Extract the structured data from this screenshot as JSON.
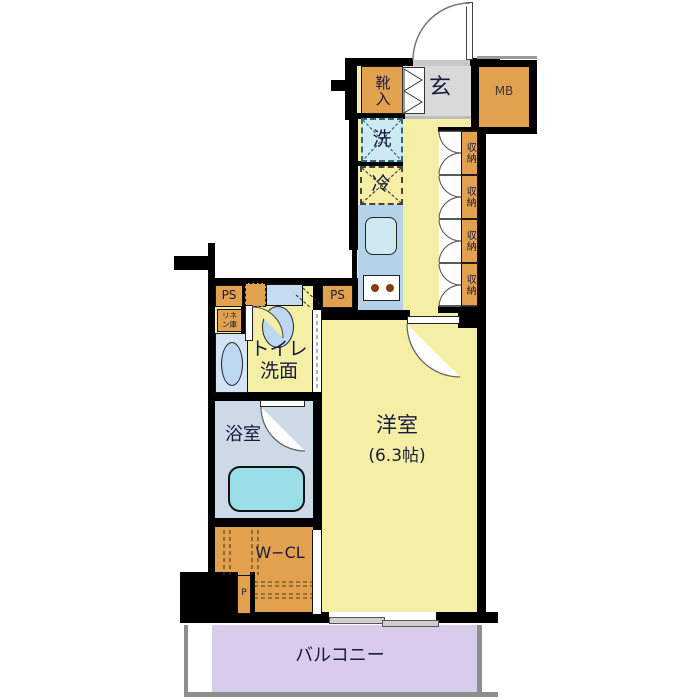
{
  "rooms": {
    "entrance": {
      "label": "玄"
    },
    "shoe_cabinet": {
      "label": "靴入"
    },
    "meter_box": {
      "label": "MB"
    },
    "washing_machine": {
      "label": "洗"
    },
    "refrigerator": {
      "label": "冷"
    },
    "storage_units": [
      {
        "label": "収納"
      },
      {
        "label": "収納"
      },
      {
        "label": "収納"
      },
      {
        "label": "収納"
      }
    ],
    "pipe_space_left": {
      "label": "PS"
    },
    "pipe_space_right": {
      "label": "PS"
    },
    "linen_closet": {
      "line1": "リネ",
      "line2": "ン庫"
    },
    "toilet_washroom": {
      "line1": "トイレ",
      "line2": "洗面"
    },
    "bathroom": {
      "label": "浴室"
    },
    "western_room": {
      "label": "洋室",
      "size": "(6.3帖)"
    },
    "walk_in_closet": {
      "label": "W−CL"
    },
    "pipe_shaft": {
      "label": "P"
    },
    "balcony": {
      "label": "バルコニー"
    }
  },
  "colors": {
    "floor_yellow": "#f4efa4",
    "cabinet_orange": "#e2a14e",
    "entry_gray": "#d9d9d9",
    "kitchen_blue": "#b6d2e8",
    "fixture_blue": "#bcd8f0",
    "washer_cyan": "#cdeaf2",
    "bath_gray_blue": "#ccd9e6",
    "bathtub_cyan": "#9adfe8",
    "balcony_purple": "#d8cbeb",
    "wall_black": "#000000",
    "text_navy": "#1a1a40"
  }
}
